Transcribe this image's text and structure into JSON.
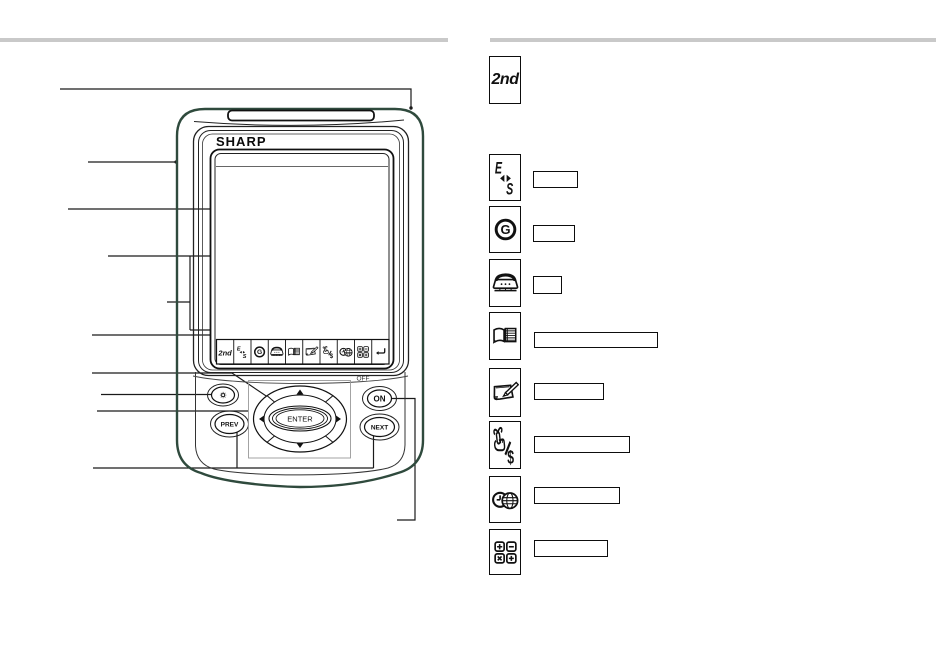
{
  "page": {
    "background": "#ffffff",
    "divider_color": "#c9c9c9",
    "line_color": "#1a1a1a",
    "case_color": "#2f4a3d"
  },
  "device": {
    "brand": "SHARP",
    "labels": {
      "second": "2nd",
      "e": "E",
      "s": "S",
      "g": "G",
      "dollar": "$",
      "enter": "ENTER",
      "prev": "PREV",
      "next": "NEXT",
      "on": "ON",
      "off": "OFF"
    },
    "touch_key_row": {
      "keys": [
        "2nd-key",
        "english-spanish-key",
        "clock-key",
        "telephone-key",
        "address-book-key",
        "memo-key",
        "schedule-expense-key",
        "clock-world-time-key",
        "calculator-key",
        "return-key"
      ]
    },
    "physical_buttons": [
      "backlight-button",
      "prev-button",
      "cursor-pad",
      "enter-button",
      "on-button",
      "next-button"
    ]
  },
  "legend": {
    "rows": [
      {
        "icon": "2nd-key-icon",
        "icon_label": "2nd",
        "label": null
      },
      {
        "icon": "english-spanish-key-icon",
        "label": ""
      },
      {
        "icon": "clock-key-icon",
        "icon_letter": "G",
        "label": ""
      },
      {
        "icon": "telephone-key-icon",
        "label": ""
      },
      {
        "icon": "address-book-key-icon",
        "label": ""
      },
      {
        "icon": "memo-key-icon",
        "label": ""
      },
      {
        "icon": "schedule-expense-key-icon",
        "icon_symbol": "$",
        "label": ""
      },
      {
        "icon": "clock-world-time-key-icon",
        "label": ""
      },
      {
        "icon": "calculator-key-icon",
        "operators": [
          "+",
          "−",
          "×",
          "+"
        ],
        "label": ""
      }
    ]
  }
}
